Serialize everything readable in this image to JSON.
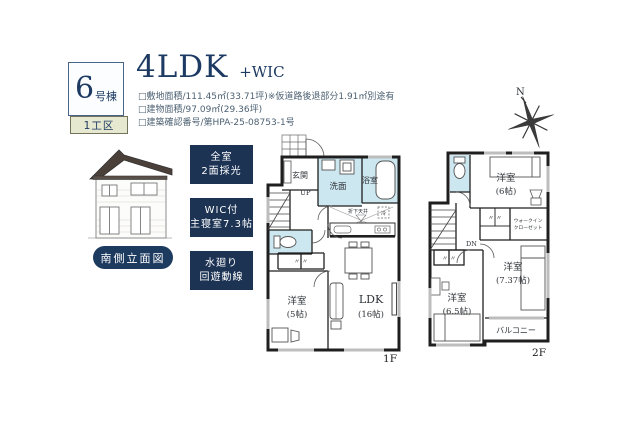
{
  "colors": {
    "navy": "#1d3a5f",
    "navy_box": "#1c3354",
    "water_room": "#cde7f0",
    "beige": "#e6e8cf",
    "wall": "#1f1f1f",
    "title_navy": "#1d3a63"
  },
  "header": {
    "badge_number": "6",
    "badge_suffix": "号棟",
    "section_label": "1工区",
    "title": "4LDK",
    "title_suffix": "+WIC",
    "specs": [
      "□敷地面積/111.45㎡(33.71坪)※仮道路後退部分1.91㎡別途有",
      "□建物面積/97.09㎡(29.36坪)",
      "□建築確認番号/第HPA-25-08753-1号"
    ]
  },
  "elevation": {
    "caption": "南側立面図"
  },
  "features": [
    {
      "line1": "全室",
      "line2": "2面採光"
    },
    {
      "line1": "WIC付",
      "line2": "主寝室7.3帖"
    },
    {
      "line1": "水廻り",
      "line2": "回遊動線"
    }
  ],
  "compass": {
    "label": "N"
  },
  "floor1": {
    "label": "1F",
    "genkan": "玄関",
    "up": "UP",
    "senmen": "洗面",
    "bath": "浴室",
    "dropped_ceiling": "折下天井",
    "fridge": "冷",
    "room5_name": "洋室",
    "room5_size": "(5帖)",
    "ldk_name": "LDK",
    "ldk_size": "(16帖)",
    "closet_marks": "〃   〃"
  },
  "floor2": {
    "label": "2F",
    "dn": "DN",
    "room6_name": "洋室",
    "room6_size": "(6帖)",
    "wic_line1": "ウォークイン",
    "wic_line2": "クローゼット",
    "room737_name": "洋室",
    "room737_size": "(7.37帖)",
    "room65_name": "洋室",
    "room65_size": "(6.5帖)",
    "balcony": "バルコニー",
    "closet_marks": "〃   〃"
  }
}
